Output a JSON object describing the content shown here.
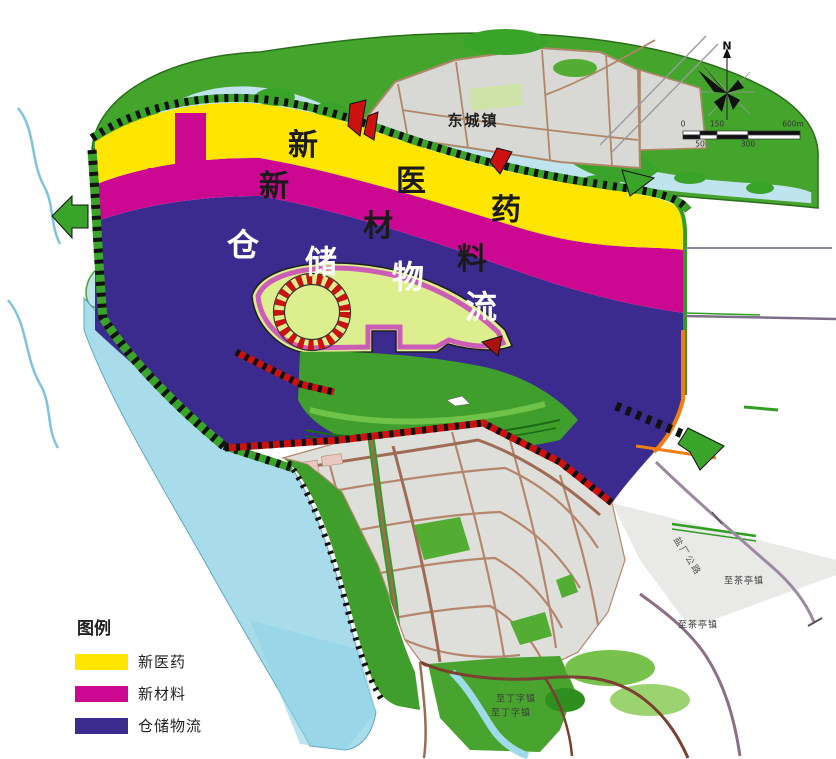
{
  "legend": {
    "title": "图例",
    "items": [
      {
        "label": "新医药",
        "color": "#ffe500"
      },
      {
        "label": "新材料",
        "color": "#cc0791"
      },
      {
        "label": "仓储物流",
        "color": "#3b2b8e"
      }
    ]
  },
  "zone_labels": {
    "yellow": [
      "新",
      "医",
      "药"
    ],
    "magenta": [
      "新",
      "材",
      "料"
    ],
    "purple": [
      "仓",
      "储",
      "物",
      "流"
    ]
  },
  "map_labels": {
    "town": "东城镇",
    "road_vertical": "盐厂公路",
    "to_chating_upper": "至茶亭镇",
    "to_chating_lower": "至茶亭镇",
    "to_dingzi_upper": "至丁字镇",
    "to_dingzi_lower": "至丁字镇"
  },
  "compass": {
    "north": "N"
  },
  "scalebar": {
    "top_labels": [
      "0",
      "150",
      "600m"
    ],
    "bottom_labels": [
      "50",
      "300"
    ]
  },
  "colors": {
    "zone_yellow": "#ffe500",
    "zone_magenta": "#cc0791",
    "zone_purple": "#3b2b8e",
    "water": "#a9dcea",
    "green": "#44a52c",
    "urban_gray": "#dedfda",
    "road_tan": "#b5866d",
    "island_green": "#dcee8e",
    "ring_red": "#cc1111",
    "orange": "#f07f13"
  }
}
